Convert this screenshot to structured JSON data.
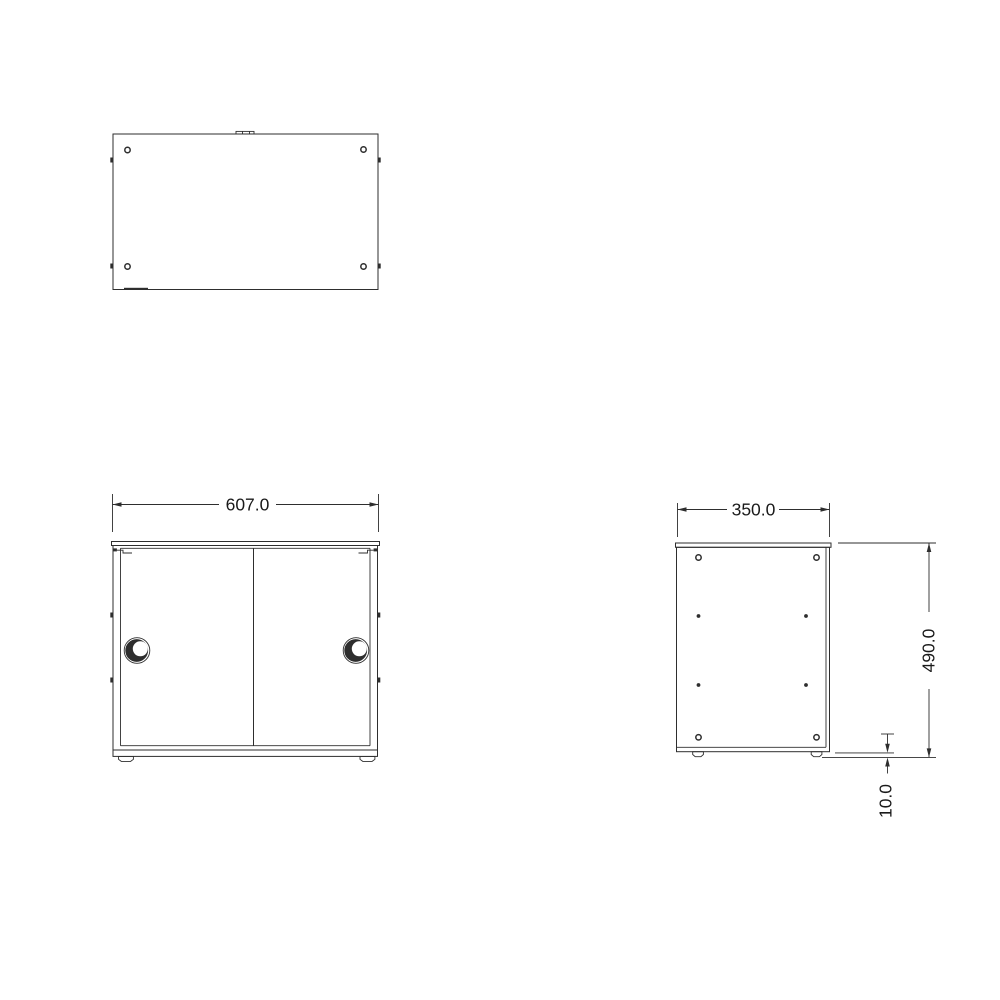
{
  "drawing": {
    "type": "technical-orthographic-drawing",
    "subject": "sliding-door cabinet, three views (top, front, side)",
    "colors": {
      "background": "#ffffff",
      "line": "#2e2e2e",
      "text": "#1a1a1a"
    }
  },
  "views": {
    "front": {
      "width_label": "607.0"
    },
    "side": {
      "depth_label": "350.0",
      "height_label": "490.0",
      "foot_height_label": "10.0"
    }
  }
}
